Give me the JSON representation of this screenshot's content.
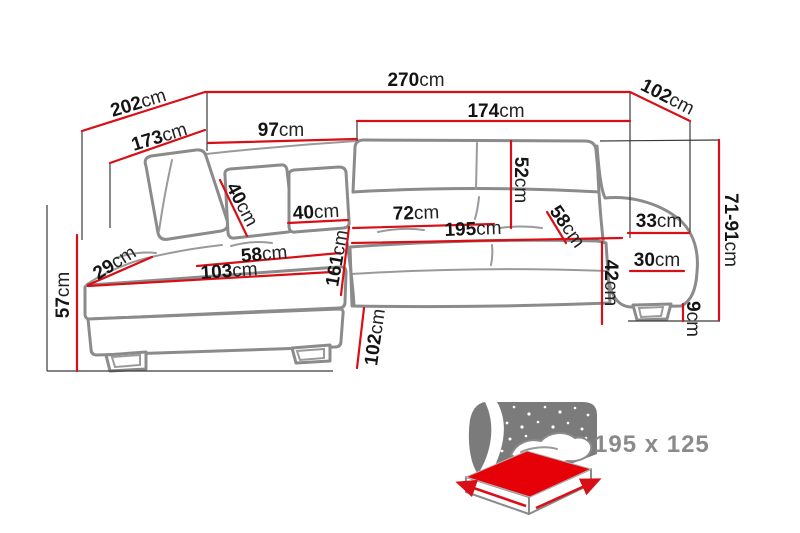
{
  "diagram": {
    "title_hint": "corner-sofa-dimension-diagram",
    "unit": "cm",
    "colors": {
      "dimension_red": "#d90f17",
      "outline_gray": "#8b8b8b",
      "text_black": "#141414",
      "icon_gray": "#7b7b7b",
      "bed_red": "#e60008"
    },
    "dimensions": {
      "total_width": {
        "value": "270",
        "unit": "cm"
      },
      "chaise_depth_outer": {
        "value": "202",
        "unit": "cm"
      },
      "chaise_depth_inner": {
        "value": "173",
        "unit": "cm"
      },
      "chaise_back_width": {
        "value": "97",
        "unit": "cm"
      },
      "back_width": {
        "value": "174",
        "unit": "cm"
      },
      "side_depth": {
        "value": "102",
        "unit": "cm"
      },
      "height_range": {
        "value": "71-91",
        "unit": "cm"
      },
      "backrest_height": {
        "value": "52",
        "unit": "cm"
      },
      "pillow_size_a": {
        "value": "40",
        "unit": "cm"
      },
      "pillow_size_b": {
        "value": "40",
        "unit": "cm"
      },
      "seat_depth_right": {
        "value": "72",
        "unit": "cm"
      },
      "sleeping_length": {
        "value": "195",
        "unit": "cm"
      },
      "seat_depth_diagonal": {
        "value": "58",
        "unit": "cm"
      },
      "armrest_top_width": {
        "value": "33",
        "unit": "cm"
      },
      "armrest_base_width": {
        "value": "30",
        "unit": "cm"
      },
      "seat_front_height": {
        "value": "42",
        "unit": "cm"
      },
      "leg_height": {
        "value": "9",
        "unit": "cm"
      },
      "chaise_seat_depth": {
        "value": "58",
        "unit": "cm"
      },
      "chaise_seat_width": {
        "value": "103",
        "unit": "cm"
      },
      "left_armrest_width": {
        "value": "29",
        "unit": "cm"
      },
      "chaise_length": {
        "value": "161",
        "unit": "cm"
      },
      "left_armrest_height": {
        "value": "57",
        "unit": "cm"
      },
      "chaise_front_width": {
        "value": "102",
        "unit": "cm"
      }
    },
    "sleeping_area": {
      "label": "195 x 125"
    }
  }
}
